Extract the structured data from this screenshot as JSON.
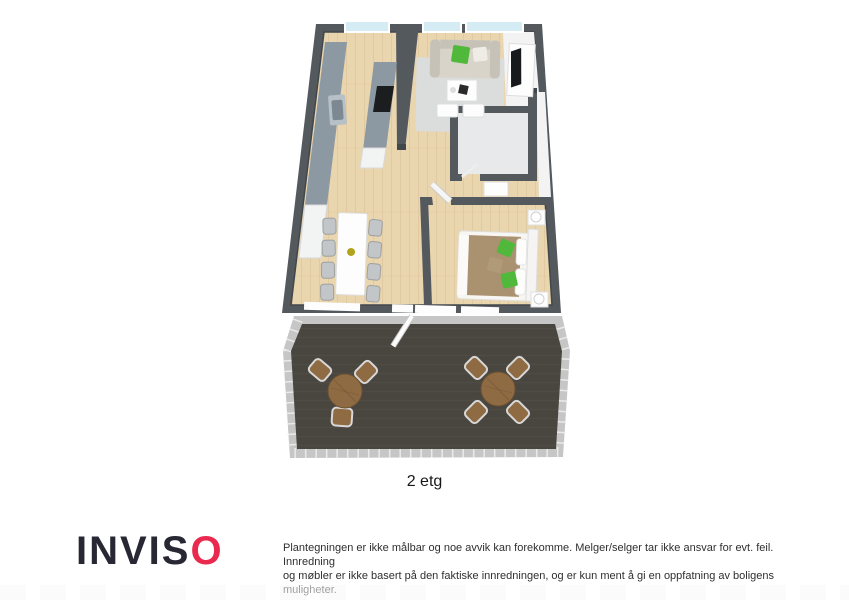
{
  "plan": {
    "floor_label": "2 etg"
  },
  "footer": {
    "logo_main": "INVIS",
    "logo_accent": "O",
    "disclaimer_line1": "Plantegningen er ikke målbar og noe avvik kan forekomme. Melger/selger tar ikke ansvar for evt. feil. Innredning",
    "disclaimer_line2": "og møbler er ikke basert på den faktiske innredningen, og er kun ment å gi en oppfatning av boligens muligheter."
  },
  "colors": {
    "wall": "#54595e",
    "wall_dark": "#42474b",
    "wood": "#e9d5ae",
    "wood_grain": "#d6bd92",
    "bath_floor": "#e8e9eb",
    "hall_floor": "#f3f3f4",
    "rug": "#dbdcdc",
    "counter": "#8d99a2",
    "counter_light": "#b7c0c6",
    "sink_basin": "#7c8892",
    "cooktop": "#1b1d1f",
    "cabinet_white": "#f2f3f3",
    "sofa": "#d8d4ca",
    "sofa_shadow": "#c6c2b8",
    "pillow_green": "#50b83a",
    "table_white": "#fdfdfd",
    "chair_gray": "#c3c6c8",
    "chair_edge": "#9da0a2",
    "centerpiece_yellow": "#b2a31c",
    "bed_blanket": "#aa9170",
    "bed_pillow_brown": "#b09a78",
    "window_glass": "#d5ecf4",
    "window_frame": "#ffffff",
    "terrace_floor": "#49453f",
    "terrace_plank": "#524e48",
    "railing": "#c6c6c6",
    "railing_gap": "#f3f3f3",
    "wood_table": "#8f6b44",
    "wood_table_dark": "#6d5132",
    "chair_frame": "#d8d8d8",
    "brand_red": "#e92a4e",
    "logo_dark": "#272833",
    "text_dark": "#171717",
    "text_gray": "#2f2f2f",
    "strip_gray": "#f8f8f8"
  }
}
